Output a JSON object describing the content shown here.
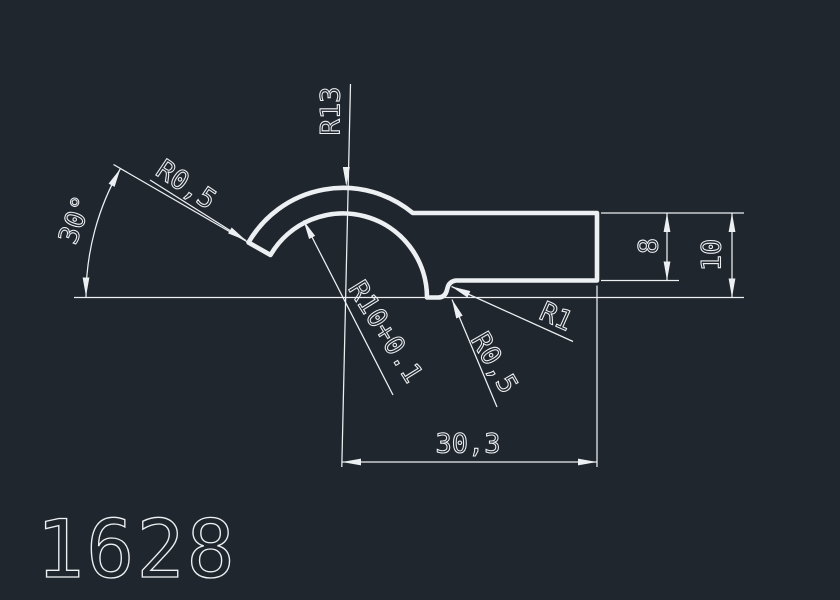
{
  "canvas": {
    "background": "#20262e",
    "line_color": "#edf0f3"
  },
  "part_number": "1628",
  "dimensions": {
    "angle": {
      "label": "30°"
    },
    "tip_corner_radius": {
      "label": "R0,5"
    },
    "outer_radius": {
      "label": "R13"
    },
    "inner_radius": {
      "label": "R10+0.1"
    },
    "step_fillet_radius": {
      "label": "R1"
    },
    "step_corner_radius": {
      "label": "R0,5"
    },
    "length": {
      "label": "30,3"
    },
    "tail_height": {
      "label": "8"
    },
    "total_height": {
      "label": "10"
    }
  }
}
